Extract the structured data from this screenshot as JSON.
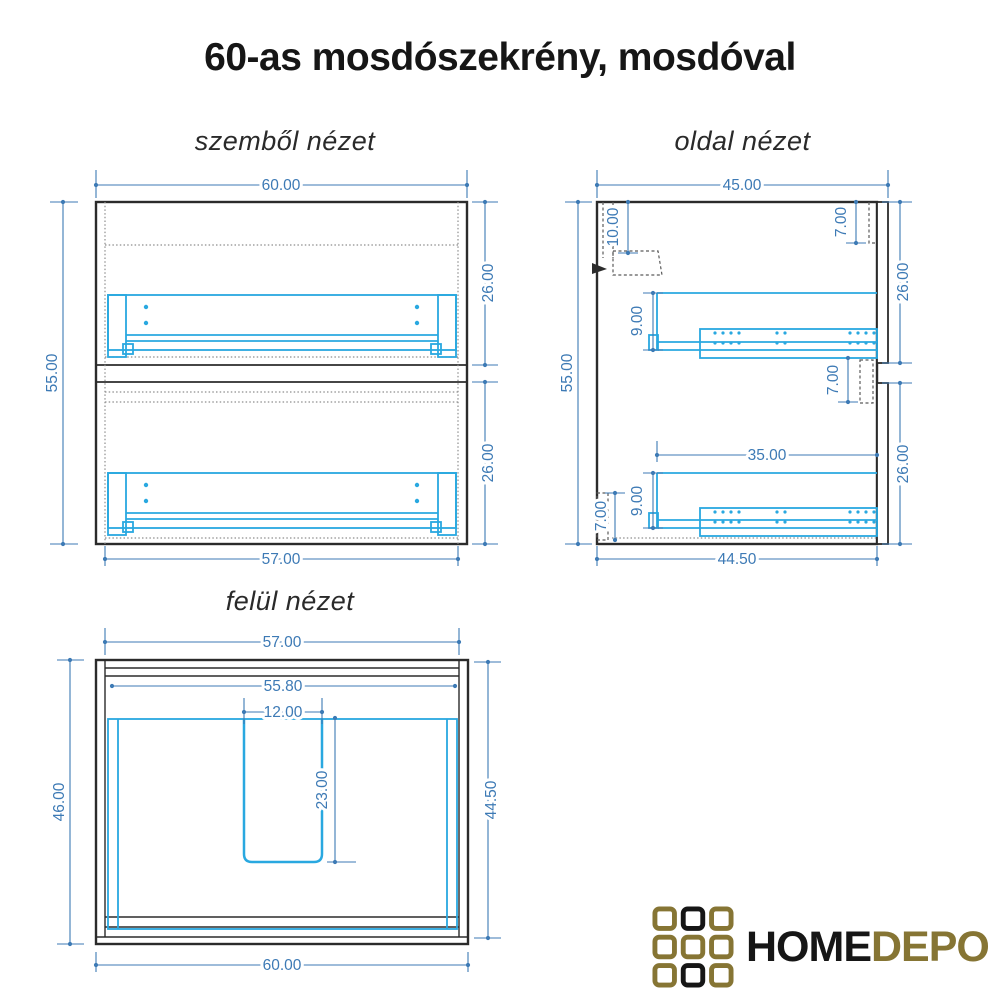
{
  "title": "60-as mosdószekrény, mosdóval",
  "views": {
    "front": {
      "label": "szemből nézet",
      "dims": {
        "width_top": "60.00",
        "height": "55.00",
        "drawer_top": "26.00",
        "drawer_bottom": "26.00",
        "width_bottom": "57.00"
      }
    },
    "side": {
      "label": "oldal nézet",
      "dims": {
        "depth_top": "45.00",
        "height": "55.00",
        "hang_rail": "10.00",
        "back_top": "7.00",
        "drawer_top": "26.00",
        "rail_top": "9.00",
        "back_mid": "7.00",
        "slide_length": "35.00",
        "rail_bottom": "9.00",
        "plinth": "7.00",
        "drawer_bottom": "26.00",
        "depth_bottom": "44.50"
      }
    },
    "top": {
      "label": "felül nézet",
      "dims": {
        "width_top": "57.00",
        "inner_width": "55.80",
        "cutout_width": "12.00",
        "cutout_depth": "23.00",
        "depth_left": "46.00",
        "depth_right": "44.50",
        "width_bottom": "60.00"
      }
    }
  },
  "logo": {
    "home": "HOME",
    "depo": "DEPO"
  },
  "colors": {
    "dim": "#3d7ab5",
    "drawer": "#29a8e0",
    "outline": "#2b2b2b",
    "dotted": "#8e8e8e",
    "logo-gold": "#867534",
    "logo-black": "#161616",
    "title": "#161616"
  }
}
